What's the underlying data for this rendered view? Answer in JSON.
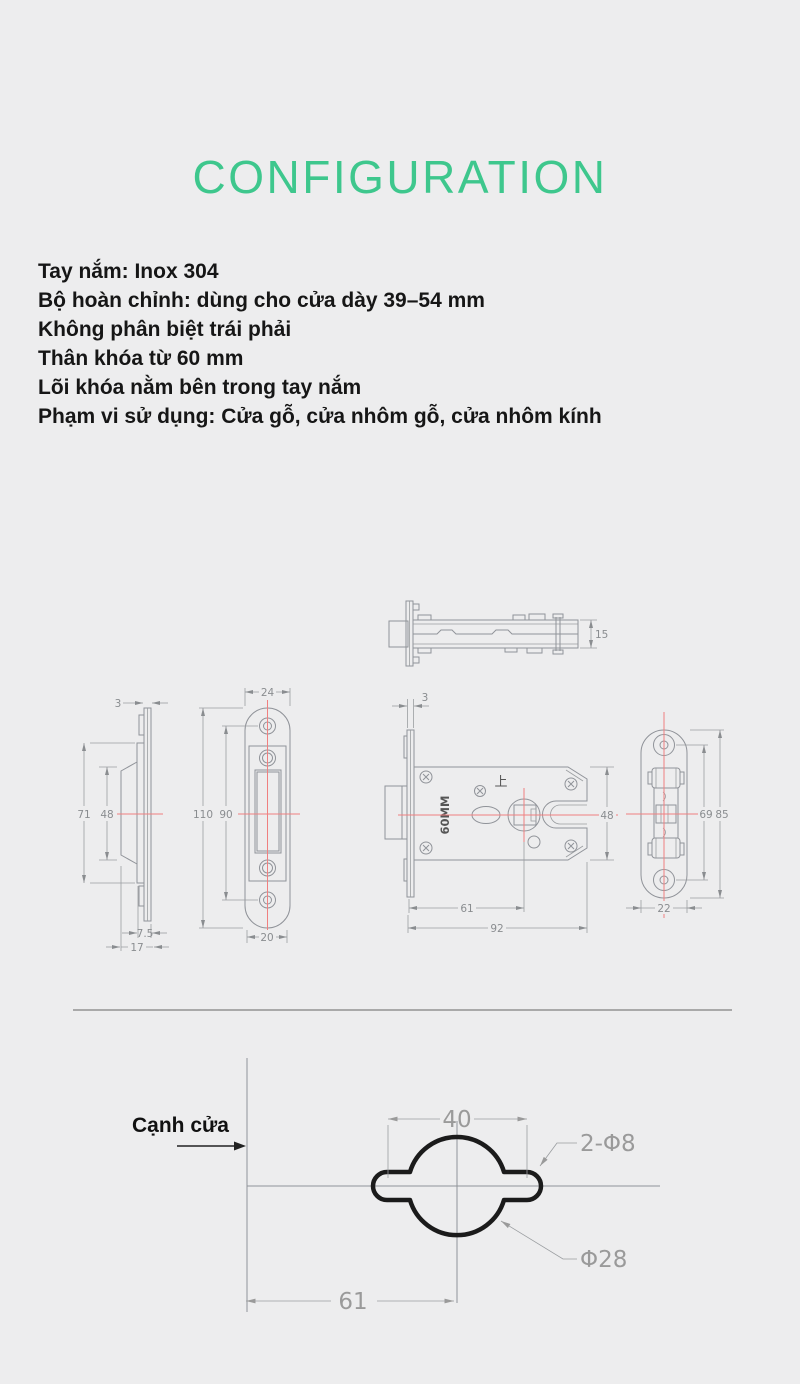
{
  "title": "CONFIGURATION",
  "specs": {
    "lines": [
      "Tay nắm: Inox 304",
      "Bộ hoàn chỉnh: dùng cho cửa dày 39–54 mm",
      "Không phân biệt trái phải",
      "Thân khóa từ 60 mm",
      "Lõi khóa nằm bên trong tay nắm",
      "Phạm vi sử dụng: Cửa gỗ, cửa nhôm gỗ, cửa nhôm kính"
    ]
  },
  "drawings": {
    "top_view": {
      "dims": {
        "height": "15"
      }
    },
    "handle_side": {
      "dims": {
        "thickness": "3",
        "outer_height": "71",
        "boss_height": "48",
        "depth_small": "7.5",
        "depth_total": "17"
      }
    },
    "strike_plate": {
      "dims": {
        "width": "24",
        "height": "110",
        "hole_span": "90",
        "slot_width": "20"
      }
    },
    "lock_body": {
      "dims": {
        "plate_thickness": "3",
        "body_height": "48",
        "backset": "61",
        "body_length": "92"
      },
      "labels": {
        "size": "60MM",
        "up": "上"
      }
    },
    "end_view": {
      "dims": {
        "hole_span": "69",
        "plate_height": "85",
        "plate_width": "22"
      }
    },
    "drill_template": {
      "edge_label": "Cạnh cửa",
      "dims": {
        "hole_spacing": "40",
        "backset": "61"
      },
      "labels": {
        "small_holes": "2-Φ8",
        "center_hole": "Φ28"
      }
    }
  },
  "colors": {
    "background": "#EDEDEE",
    "accent_green": "#3EC78D",
    "drawing_line": "#909399",
    "centerline_red": "#F08080",
    "template_outline": "#1B1B1B",
    "dimension_text": "#8A8D90",
    "body_text": "#161616"
  }
}
